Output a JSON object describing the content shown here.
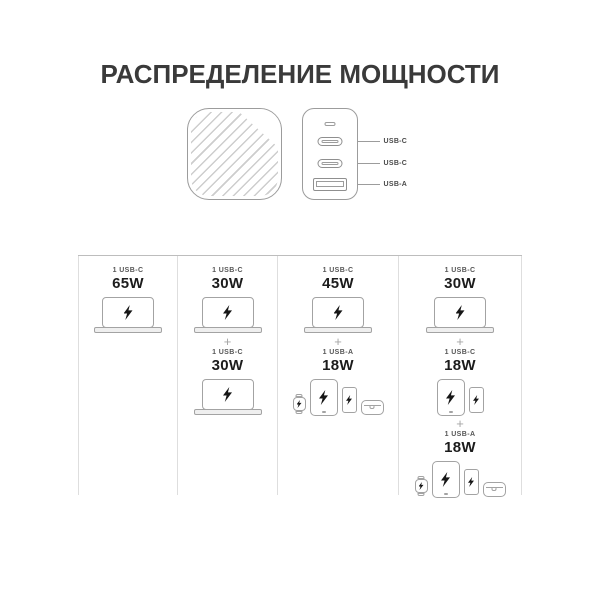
{
  "title": "РАСПРЕДЕЛЕНИЕ МОЩНОСТИ",
  "charger": {
    "front_icon": "charger-front-hatched",
    "ports": [
      {
        "label": "USB-C",
        "icon": "usb-c-port"
      },
      {
        "label": "USB-C",
        "icon": "usb-c-port"
      },
      {
        "label": "USB-A",
        "icon": "usb-a-port"
      }
    ]
  },
  "plus": "+",
  "table": {
    "columns": [
      {
        "groups": [
          {
            "port": "1 USB-C",
            "watt": "65W",
            "devices": [
              "laptop"
            ]
          }
        ]
      },
      {
        "groups": [
          {
            "port": "1 USB-C",
            "watt": "30W",
            "devices": [
              "laptop"
            ]
          },
          {
            "port": "1 USB-C",
            "watt": "30W",
            "devices": [
              "laptop"
            ]
          }
        ]
      },
      {
        "groups": [
          {
            "port": "1 USB-C",
            "watt": "45W",
            "devices": [
              "laptop"
            ]
          },
          {
            "port": "1 USB-A",
            "watt": "18W",
            "devices": [
              "watch",
              "tablet",
              "phone",
              "earbuds"
            ]
          }
        ]
      },
      {
        "groups": [
          {
            "port": "1 USB-C",
            "watt": "30W",
            "devices": [
              "laptop"
            ]
          },
          {
            "port": "1 USB-C",
            "watt": "18W",
            "devices": [
              "tablet",
              "phone"
            ]
          },
          {
            "port": "1 USB-A",
            "watt": "18W",
            "devices": [
              "watch",
              "tablet",
              "phone",
              "earbuds"
            ]
          }
        ]
      }
    ]
  }
}
